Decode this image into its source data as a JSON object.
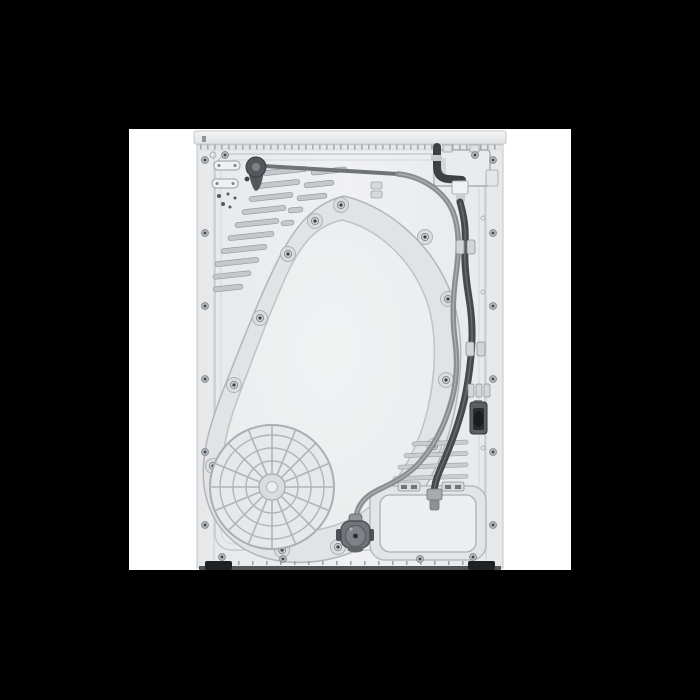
{
  "meta": {
    "subject": "Rear view of a white tumble dryer - studio product photo",
    "visible_text": "none"
  },
  "canvas": {
    "background_color": "#000000",
    "photo_area": {
      "background_color": "#ffffff",
      "x": 129,
      "y": 129,
      "width": 442,
      "height": 441
    }
  },
  "colors": {
    "background": "#000000",
    "photo_background": "#ffffff",
    "cabinet_body": "#edeff0",
    "cabinet_edge": "#c2c6c9",
    "drum_plate_band": "#e1e3e5",
    "drum_plate_line": "#b2b6bb",
    "grille_line": "#b0b5b9",
    "cable_gray": "#888d92",
    "cable_dark": "#45494e",
    "plug_body": "#707479",
    "feet": "#1f2225",
    "knob": "#53575c",
    "recess": "#e2e4e6",
    "junction_box": "#e9ebed"
  },
  "machine": {
    "parts": [
      "top-panel-edge",
      "rear-panel",
      "upper-left-air-vents",
      "lower-right-air-vents",
      "drum-back-plate",
      "drum-plate-screws",
      "fan-grille",
      "mains-junction-box",
      "power-cable",
      "inlet-cable",
      "cable-clips",
      "drain-connector",
      "service-panel",
      "power-plug",
      "leveling-feet",
      "hose-grommet",
      "support-rod"
    ]
  }
}
